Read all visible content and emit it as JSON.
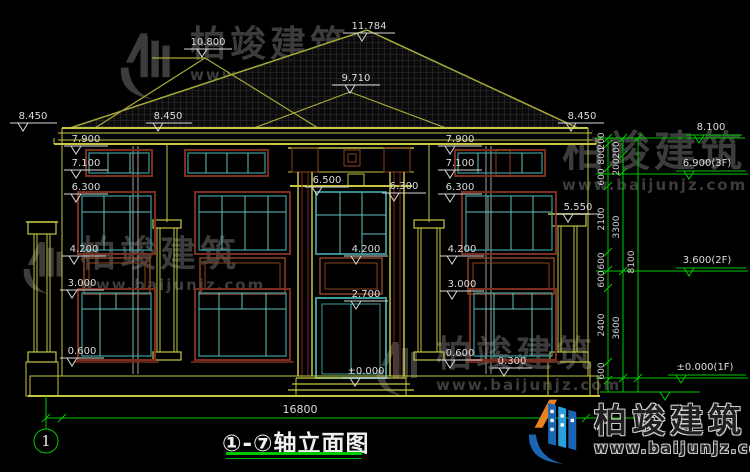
{
  "drawing": {
    "title": "①-⑦轴立面图",
    "axis_bubble": "1",
    "total_width_dim": "16800"
  },
  "m": {
    "peak": "11.784",
    "ridge_l": "10.800",
    "ridge_f": "9.710",
    "eave_l": "8.450",
    "eave_m": "8.450",
    "eave_r": "8.450",
    "l_7900": "7.900",
    "l_7100": "7.100",
    "l_6300": "6.300",
    "l_4200": "4.200",
    "l_3000": "3.000",
    "l_0600": "0.600",
    "c_6500": "6.500",
    "c_6300": "6.300",
    "c_4200": "4.200",
    "c_2700": "2.700",
    "c_0000": "±0.000",
    "r_7900": "7.900",
    "r_7100": "7.100",
    "r_6300": "6.300",
    "r_5550": "5.550",
    "r_4200": "4.200",
    "r_3000": "3.000",
    "r_0600": "0.600",
    "r_0300": "0.300"
  },
  "story": [
    "8.100",
    "6.900(3F)",
    "3.600(2F)",
    "±0.000(1F)"
  ],
  "chain1": [
    "200",
    "800",
    "600",
    "2100",
    "600",
    "600",
    "2400",
    "600"
  ],
  "chain2": [
    "200",
    "200",
    "3300",
    "3600"
  ],
  "chain3": [
    "8100"
  ],
  "watermark": {
    "brand": "柏竣建筑",
    "url": "www.baijunjz.com"
  },
  "logo": {
    "brand": "柏竣建筑",
    "url": "www.baijunjz.com"
  },
  "colors": {
    "background": "#000000",
    "cad_yellow": "#c6c642",
    "roof_grid": "#3e3e3e",
    "frame_brown": "#7b2d1e",
    "frame_teal": "#3c9c9c",
    "dim_green": "#00c800",
    "text_white": "#dcdcdc",
    "watermark_gray": "#3c3c3c",
    "logo_blue": "#1b66b4",
    "logo_orange": "#e8821e"
  }
}
